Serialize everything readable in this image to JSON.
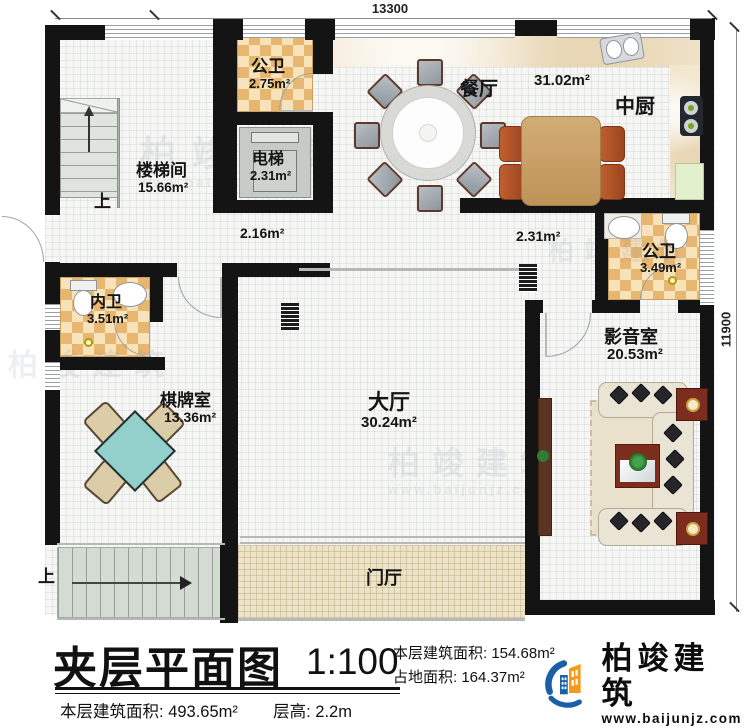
{
  "plan": {
    "dimensions": {
      "width_mm": "13300",
      "height_mm": "11900"
    },
    "rooms": [
      {
        "name": "楼梯间",
        "area": "15.66m²"
      },
      {
        "name": "公卫",
        "area": "2.75m²"
      },
      {
        "name": "电梯",
        "area": "2.31m²"
      },
      {
        "name": "餐厅",
        "area": "31.02m²"
      },
      {
        "name": "中厨",
        "area": ""
      },
      {
        "name": "公卫",
        "area": "3.49m²"
      },
      {
        "name": "影音室",
        "area": "20.53m²"
      },
      {
        "name": "大厅",
        "area": "30.24m²"
      },
      {
        "name": "内卫",
        "area": "3.51m²"
      },
      {
        "name": "棋牌室",
        "area": "13.36m²"
      },
      {
        "name": "门厅",
        "area": ""
      }
    ],
    "annotations": {
      "corridor_left": "2.16m²",
      "corridor_right": "2.31m²",
      "stairs_up": "上"
    }
  },
  "title_block": {
    "title": "夹层平面图",
    "scale": "1:100",
    "floor_area_label": "本层建筑面积:",
    "floor_area_value": "154.68m²",
    "site_area_label": "占地面积:",
    "site_area_value": "164.37m²",
    "total_area_label": "本层建筑面积:",
    "total_area_value": "493.65m²",
    "storey_height_label": "层高:",
    "storey_height_value": "2.2m"
  },
  "logo": {
    "name": "柏竣建筑",
    "url": "www.baijunjz.com"
  },
  "watermark": {
    "text": "柏竣建筑",
    "sub": "www.baijunjz.com"
  },
  "colors": {
    "wall": "#141414",
    "tile_dark": "#e7b671",
    "tile_light": "#f7e2ba",
    "chess_table": "#93d0cb",
    "sofa": "#e9e4d4",
    "table_wood": "#c9a26a",
    "chair_red": "#b14f27",
    "logo_blue": "#1b5fa8",
    "logo_orange": "#f59a1d"
  }
}
